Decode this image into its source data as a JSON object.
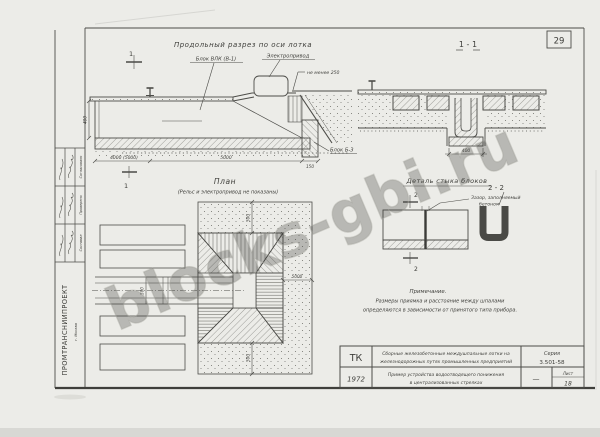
{
  "page": {
    "number": "29",
    "watermark": "blocks-gbi.ru",
    "org": "ПРОМТРАНСНИИПРОЕКТ",
    "org_city": "г. Москва"
  },
  "colors": {
    "paper": "#ecece8",
    "ink": "#4c4c48",
    "watermark": "#aeaea6"
  },
  "stamp": {
    "rows": [
      {
        "role": "Согласовано"
      },
      {
        "role": "Проверено"
      },
      {
        "role": "Составил"
      }
    ]
  },
  "longitudinal": {
    "title": "Продольный разрез по оси лотка",
    "marker": "1",
    "labels": {
      "block_vlk": "Блок ВЛК (В-1)",
      "drive": "Электропривод",
      "min_depth": "не менее 250",
      "block_b3": "Блок Б-3"
    },
    "dims": {
      "left_height": "400",
      "span1": "4000 (5000)",
      "span2": "5000",
      "span3": "150"
    }
  },
  "section11": {
    "title": "1 - 1",
    "dim_width": "400"
  },
  "detail": {
    "title": "Деталь стыка блоков",
    "marker": "2",
    "gap_label_1": "Зазор, заполняемый",
    "gap_label_2": "бетоном",
    "section22_title": "2 - 2"
  },
  "plan": {
    "title": "План",
    "subtitle": "(Рельс и электропривод не показаны)",
    "marker": "1",
    "dims": {
      "top": "500",
      "right": "5000",
      "bottom": "500",
      "track": "500"
    }
  },
  "note": {
    "heading": "Примечание.",
    "line1": "Размеры приямка и расстояние между шпалами",
    "line2": "определяются в зависимости от принятого типа прибора."
  },
  "titleblock": {
    "code": "ТК",
    "year": "1972",
    "title_line1": "Сборные железобетонные междушпальные лотки на",
    "title_line2": "железнодорожных путях промышленных предприятий",
    "series_label": "Серия",
    "series": "3.501-58",
    "subtitle_line1": "Пример устройства водоотводящего понижения",
    "subtitle_line2": "в централизованных стрелках",
    "dash": "—",
    "sheet_label": "Лист",
    "sheet": "18"
  }
}
